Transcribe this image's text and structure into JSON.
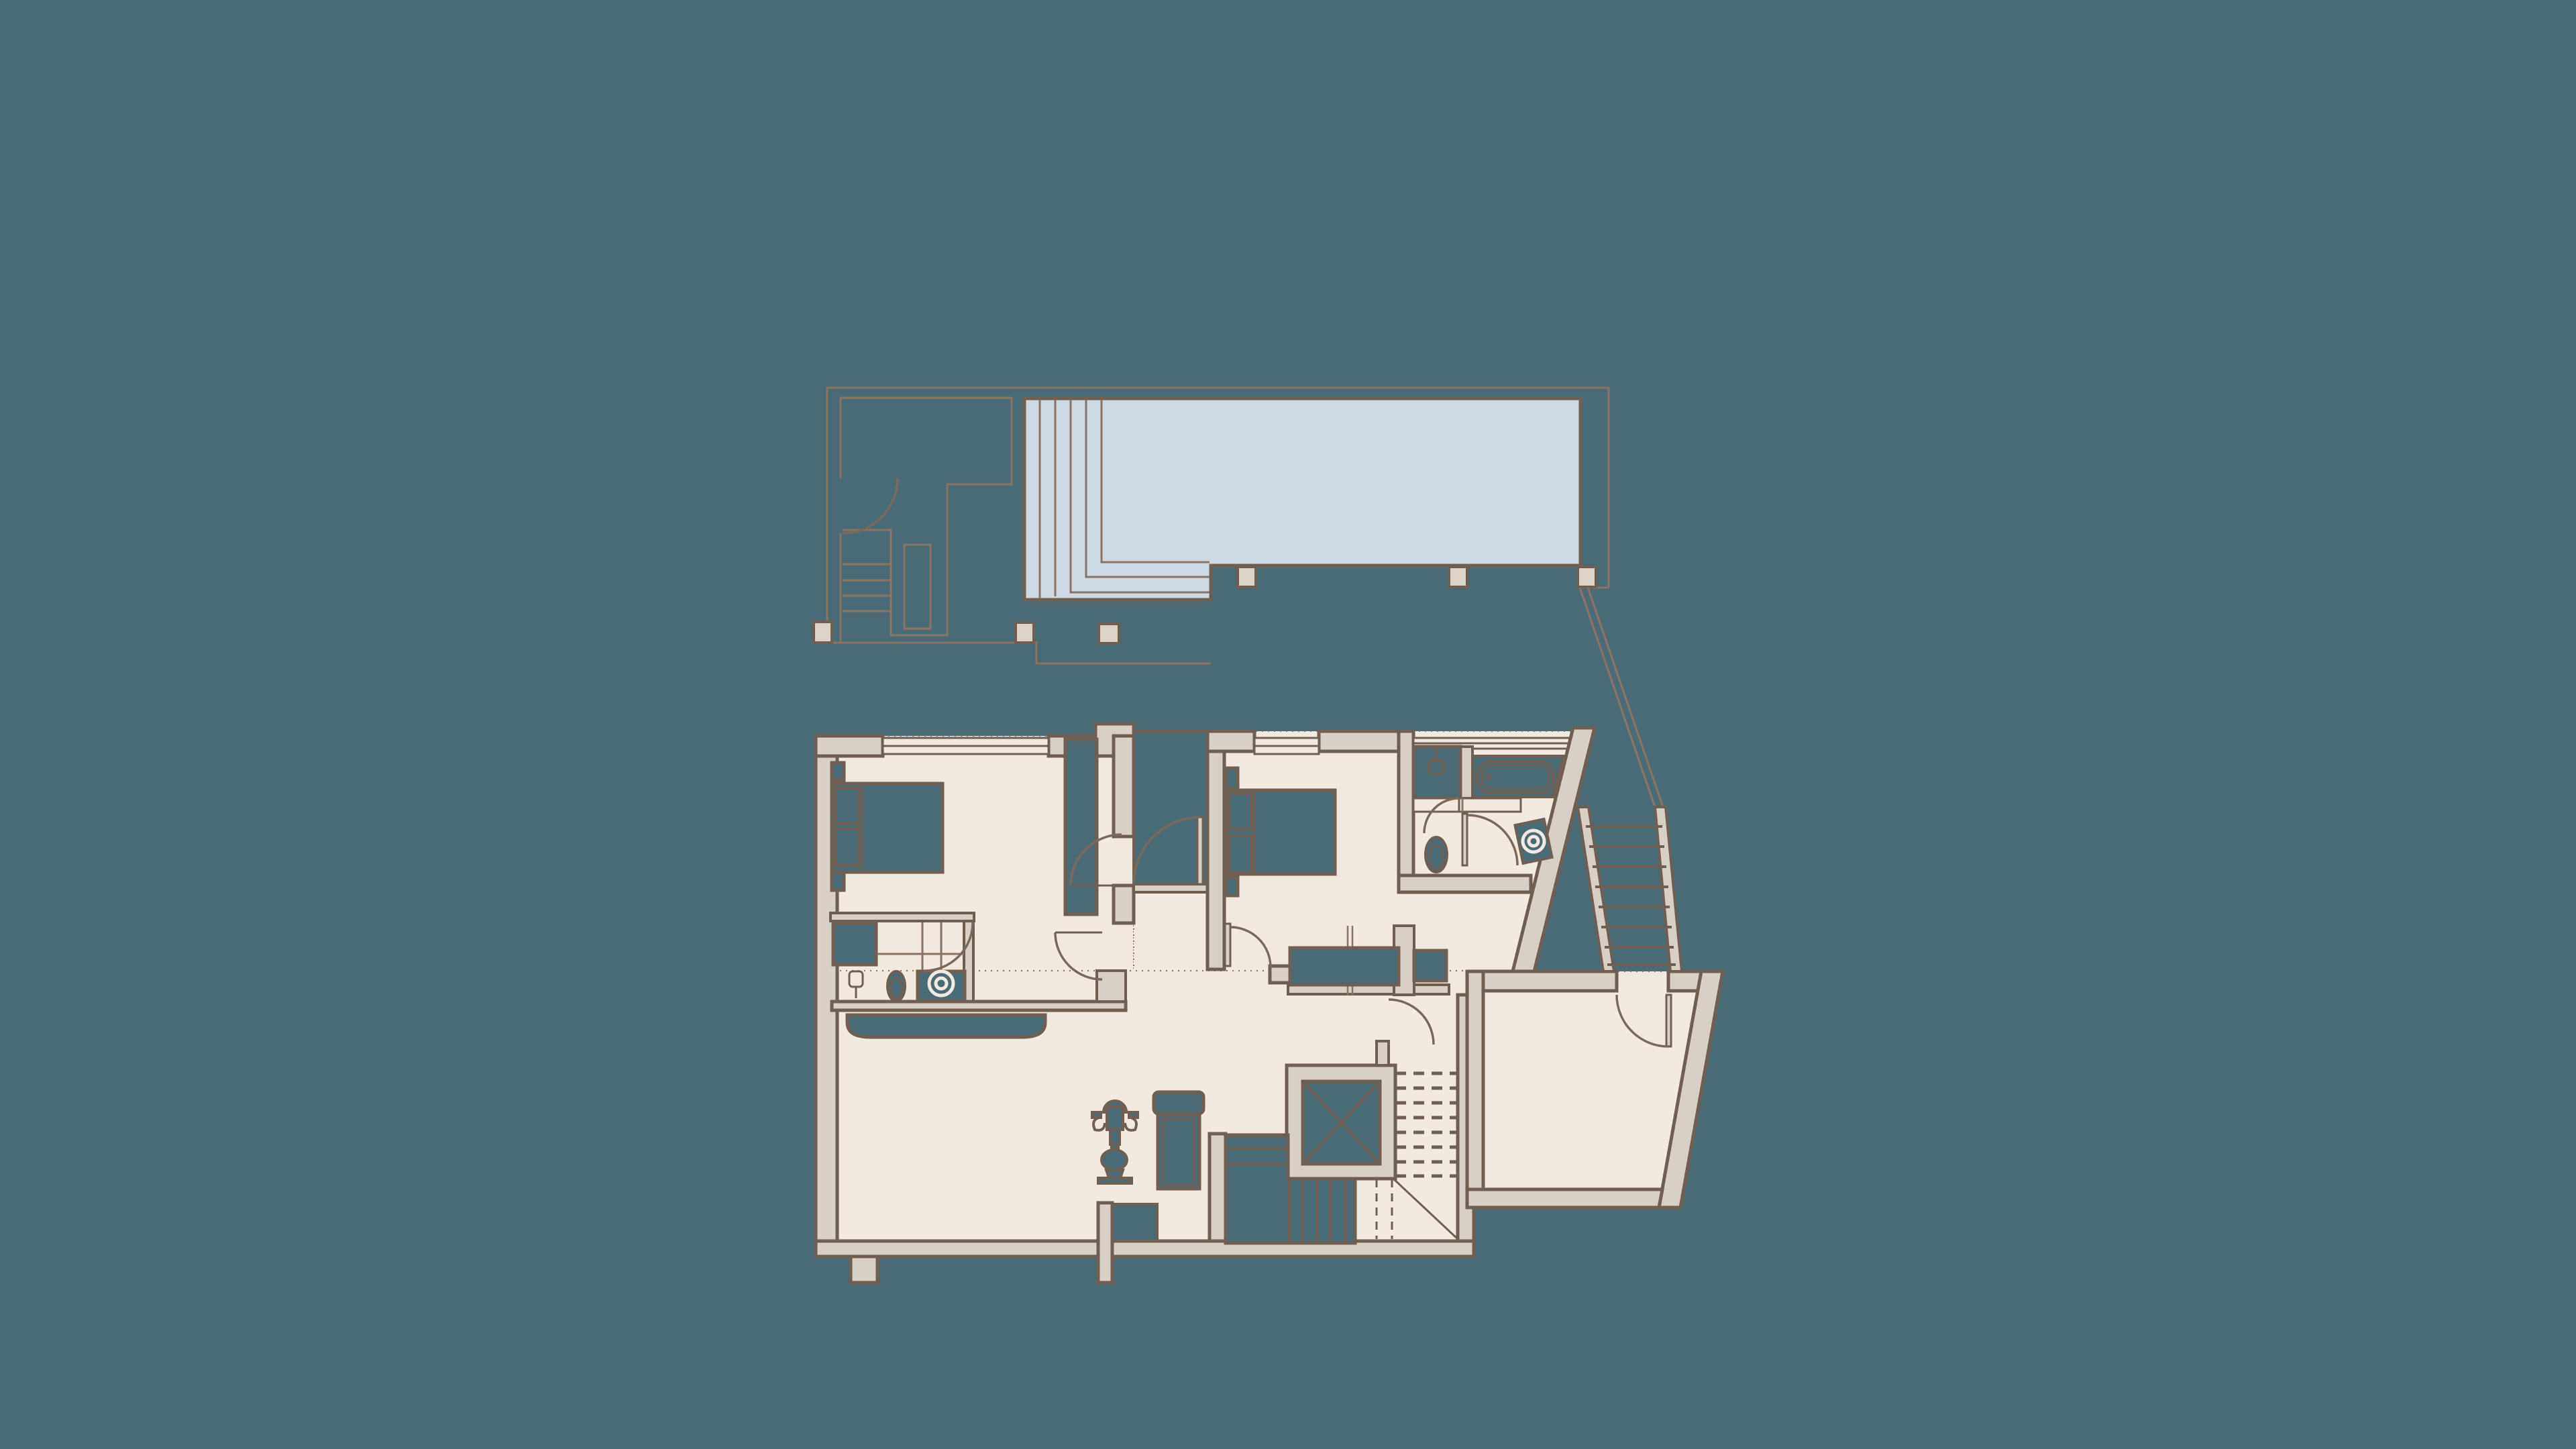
{
  "colors": {
    "background": "#4A6A75",
    "floor": "#F2EAE1",
    "wall": "#D8D0C6",
    "wall_stroke": "#6F5F53",
    "line_thin": "#8A7362",
    "pool": "#CDD9E3",
    "column": "#DBD3C8",
    "door_arc": "#7A695B"
  },
  "floorplan": {
    "type": "architectural-floor-plan",
    "level": "bedroom-and-pool-terrace-level",
    "rooms": [
      {
        "name": "pool-terrace"
      },
      {
        "name": "swimming-pool"
      },
      {
        "name": "bedroom-1"
      },
      {
        "name": "ensuite-bathroom"
      },
      {
        "name": "entrance-porch"
      },
      {
        "name": "bedroom-2"
      },
      {
        "name": "bathroom-2"
      },
      {
        "name": "hallway"
      },
      {
        "name": "gym-area"
      },
      {
        "name": "stair-core"
      },
      {
        "name": "entry-room"
      }
    ],
    "fixtures": [
      "pool-steps",
      "terrace-stairs",
      "terrace-railing",
      "columns",
      "double-bed-1",
      "double-bed-2",
      "nightstands",
      "wardrobe",
      "shower-1",
      "toilet-1",
      "washbasin-1",
      "pedestal-fixture",
      "shower-2",
      "bathtub",
      "vanity-counter",
      "toilet-2",
      "tilted-washbasin-unit",
      "closets",
      "elevator",
      "main-staircase",
      "lower-staircase",
      "exercise-machine",
      "workout-bench",
      "curved-bench",
      "exterior-staircase",
      "walkway-edge",
      "door-swings",
      "windows"
    ]
  }
}
